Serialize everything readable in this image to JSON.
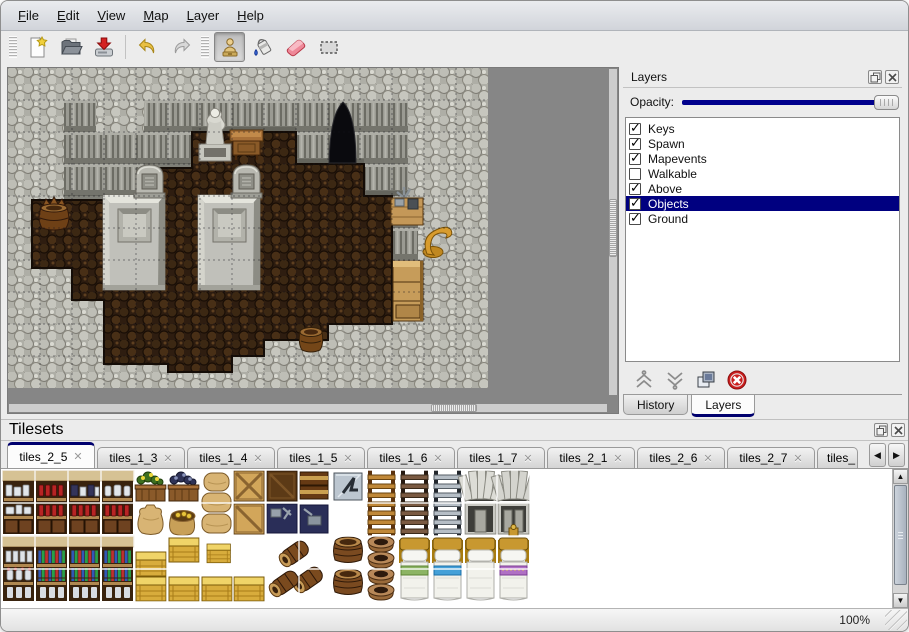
{
  "menubar": {
    "items": [
      {
        "label": "File"
      },
      {
        "label": "Edit"
      },
      {
        "label": "View"
      },
      {
        "label": "Map"
      },
      {
        "label": "Layer"
      },
      {
        "label": "Help"
      }
    ]
  },
  "toolbar": {
    "buttons": [
      {
        "name": "new-map"
      },
      {
        "name": "open-map"
      },
      {
        "name": "save-map"
      },
      {
        "name": "undo"
      },
      {
        "name": "redo"
      },
      {
        "name": "stamp-tool",
        "active": true
      },
      {
        "name": "fill-tool"
      },
      {
        "name": "eraser-tool"
      },
      {
        "name": "rect-select-tool"
      }
    ]
  },
  "map_view": {
    "scene_objects": [
      "stone-wall",
      "dirt-floor",
      "cave-entrance",
      "statue",
      "table",
      "gravestone",
      "gravestone",
      "stone-platform",
      "stone-platform",
      "barrel",
      "barrel",
      "supply-crate",
      "golden-horn",
      "cabinet"
    ]
  },
  "layers_panel": {
    "title": "Layers",
    "opacity_label": "Opacity:",
    "opacity_value": 1.0,
    "layers": [
      {
        "label": "Keys",
        "checked": true
      },
      {
        "label": "Spawn",
        "checked": true
      },
      {
        "label": "Mapevents",
        "checked": true
      },
      {
        "label": "Walkable",
        "checked": false
      },
      {
        "label": "Above",
        "checked": true
      },
      {
        "label": "Objects",
        "checked": true,
        "selected": true
      },
      {
        "label": "Ground",
        "checked": true
      }
    ],
    "buttons": [
      "raise-layer",
      "lower-layer",
      "duplicate-layer",
      "delete-layer"
    ],
    "tabs": [
      {
        "label": "History",
        "active": false
      },
      {
        "label": "Layers",
        "active": true
      }
    ]
  },
  "tilesets_panel": {
    "title": "Tilesets",
    "tabs": [
      {
        "label": "tiles_2_5",
        "active": true
      },
      {
        "label": "tiles_1_3"
      },
      {
        "label": "tiles_1_4"
      },
      {
        "label": "tiles_1_5"
      },
      {
        "label": "tiles_1_6"
      },
      {
        "label": "tiles_1_7"
      },
      {
        "label": "tiles_2_1"
      },
      {
        "label": "tiles_2_6"
      },
      {
        "label": "tiles_2_7"
      },
      {
        "label": "tiles_",
        "truncated": true
      }
    ],
    "tile_types": [
      "shelf-dishes",
      "shelf-bottles",
      "shelf-pots",
      "shelf-jars",
      "flower-box",
      "dark-flower-box",
      "sack",
      "open-sack",
      "sack-stack",
      "crate-light",
      "crate-dark",
      "tool-box",
      "chest-stack",
      "metal-sign",
      "ladder-brown",
      "ladder-dark",
      "ladder-gray",
      "stone-doorway-a",
      "stone-doorway-b",
      "shelf-apothecary",
      "shelf-books",
      "gold-crates",
      "barrel-pile",
      "barrel-upright",
      "clay-pots",
      "bed-green",
      "bed-blue",
      "bed-plain",
      "bed-purple"
    ]
  },
  "statusbar": {
    "zoom": "100%"
  },
  "icons": {
    "check": "✓",
    "close": "✕",
    "tab_prev": "◀",
    "tab_next": "▶",
    "scroll_up": "▲",
    "scroll_down": "▼"
  },
  "colors": {
    "selection": "#000080",
    "opacity_track": "#00008c",
    "tab_accent": "#00006e",
    "map_backdrop": "#868686"
  }
}
